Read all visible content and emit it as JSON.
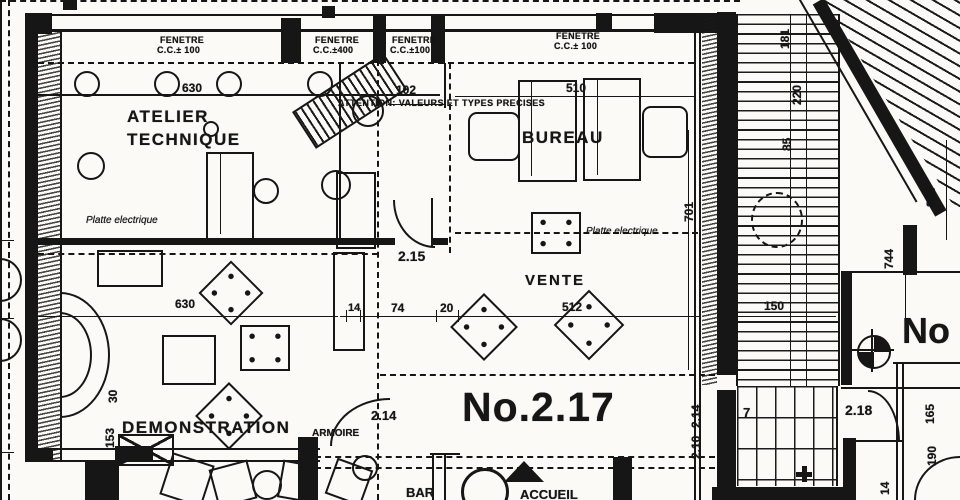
{
  "title_block": {
    "unit_number": "No.2.17",
    "adjacent_unit_number": "No"
  },
  "rooms": {
    "atelier_line1": "ATELIER",
    "atelier_line2": "TECHNIQUE",
    "bureau": "BUREAU",
    "vente": "VENTE",
    "demonstration": "DEMONSTRATION",
    "bar": "BAR",
    "accueil": "ACCUEIL",
    "armoire": "ARMOIRE"
  },
  "notes": {
    "attention": "ATTENTION: VALEURS ET TYPES PRECISES",
    "platte_atelier": "Platte electrique",
    "platte_bureau": "Platte electrique"
  },
  "windows": [
    {
      "label": "FENETRE",
      "sill": "C.C.± 100"
    },
    {
      "label": "FENETRE",
      "sill": "C.C.±400"
    },
    {
      "label": "FENETRE",
      "sill": "C.C.±100"
    },
    {
      "label": "FENETRE",
      "sill": "C.C.± 100"
    }
  ],
  "dimensions": {
    "atelier_width": "630",
    "niche_width": "102",
    "bureau_width": "510",
    "door_atelier": "2.15",
    "vente_depth": "701",
    "demo_width": "630",
    "demo_step": "30",
    "demo_left": "153",
    "nook_a": "14",
    "nook_b": "74",
    "nook_c": "20",
    "door_demo": "2.14",
    "vente_width": "512",
    "stair_width": "150",
    "stair_length": "744",
    "roof_length": "800",
    "chain_a": "181",
    "chain_b": "220",
    "chain_c": "85",
    "door_right": "2.18",
    "room_right_a": "165",
    "room_right_b": "190",
    "corner_small": "14",
    "stair_door_a": "2.14",
    "stair_door_b": "2.10",
    "stair_number": "7"
  },
  "colors": {
    "ink": "#161616",
    "paper": "#fbfaf6"
  }
}
